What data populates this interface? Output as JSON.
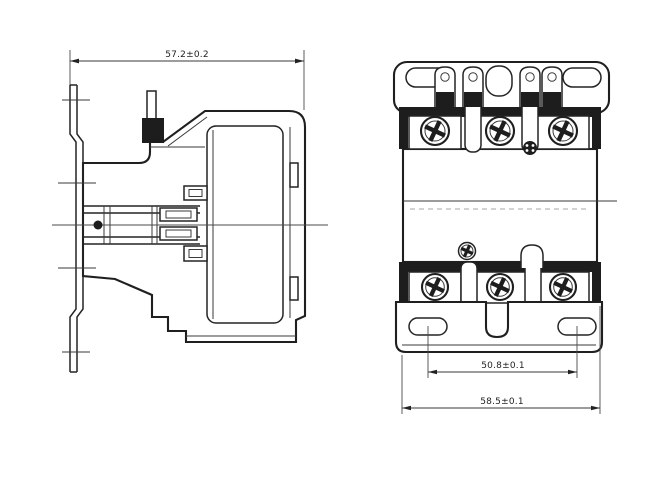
{
  "page": {
    "background": "#ffffff",
    "line_color": "#242424",
    "dark_fill": "#1d1d1d",
    "text_color": "#222222"
  },
  "drawing": {
    "kind": "two-view engineering drawing of a definite-purpose contactor",
    "views": [
      {
        "name": "side-view",
        "dimension_labels": [
          "57.2±0.2"
        ]
      },
      {
        "name": "front-view",
        "dimension_labels": [
          "50.8±0.1",
          "58.5±0.1"
        ]
      }
    ]
  },
  "dimensions": {
    "side_width": "57.2±0.2",
    "hole_spacing": "50.8±0.1",
    "overall_width": "58.5±0.1"
  }
}
